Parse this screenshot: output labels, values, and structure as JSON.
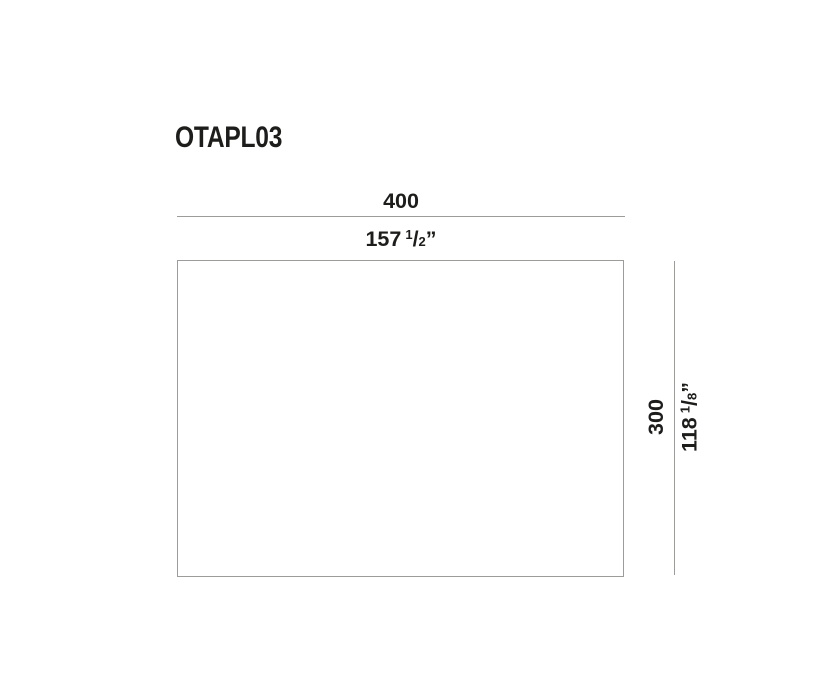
{
  "drawing": {
    "product_code": "OTAPL03",
    "width_dim": {
      "mm": "400",
      "inch_whole": "157",
      "inch_frac_num": "1",
      "inch_frac_slash": "/",
      "inch_frac_den": "2",
      "inch_mark": "”"
    },
    "height_dim": {
      "mm": "300",
      "inch_whole": "118",
      "inch_frac_num": "1",
      "inch_frac_slash": "/",
      "inch_frac_den": "8",
      "inch_mark": "”"
    }
  },
  "colors": {
    "text": "#1d1d1b",
    "dimension_line": "#9c9c9b",
    "background": "#ffffff"
  }
}
